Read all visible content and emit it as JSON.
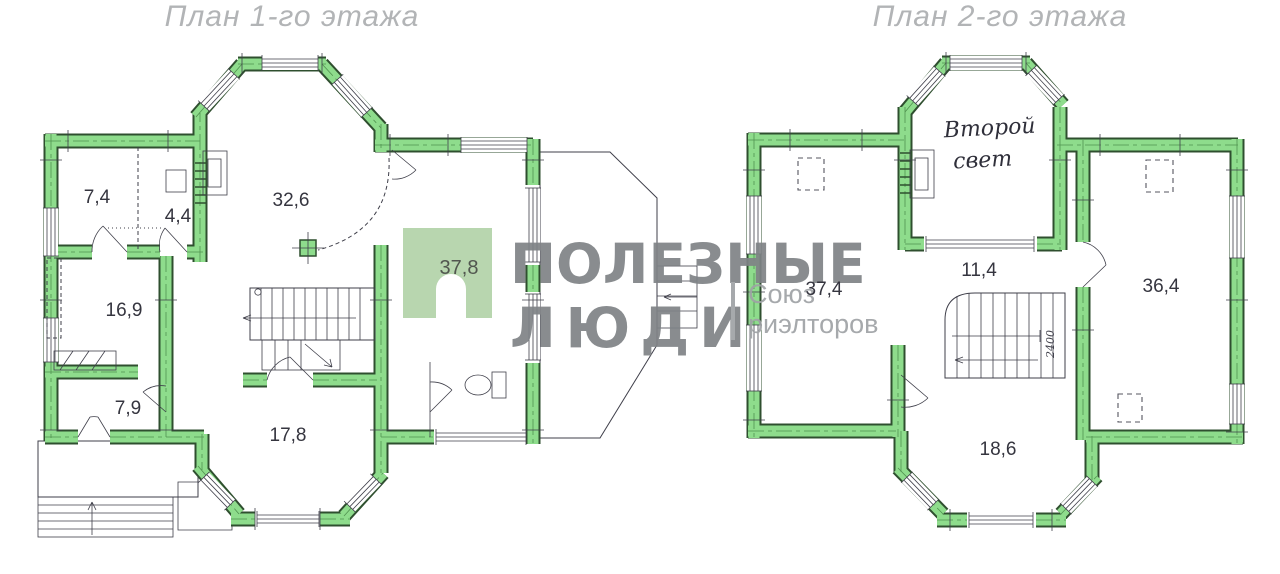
{
  "floor1": {
    "title": "План 1-го этажа",
    "room_labels": {
      "room_7_4": "7,4",
      "room_4_4": "4,4",
      "room_32_6": "32,6",
      "room_16_9": "16,9",
      "room_7_9": "7,9",
      "room_17_8": "17,8",
      "room_37_8": "37,8"
    }
  },
  "floor2": {
    "title": "План 2-го этажа",
    "annotation_line1": "Второй",
    "annotation_line2": "свет",
    "stair_dimension": "2400",
    "room_labels": {
      "room_37_4": "37,4",
      "room_11_4": "11,4",
      "room_36_4": "36,4",
      "room_18_6": "18,6"
    }
  },
  "watermark": {
    "brand_line1": "ПОЛЕЗНЫЕ",
    "brand_line2": "ЛЮДИ",
    "union_line1": "Союз",
    "union_line2": "риэлторов"
  },
  "colors": {
    "background": "#ffffff",
    "wall_fill": "#8edc8c",
    "wall_outline": "#2f4f2f",
    "drawing_line": "#3f3f4a",
    "title_gray": "#b2b4b6",
    "watermark_gray": "#7f8386",
    "watermark_light": "#9fa2a5",
    "logo_square_green": "#b2d2a8"
  }
}
